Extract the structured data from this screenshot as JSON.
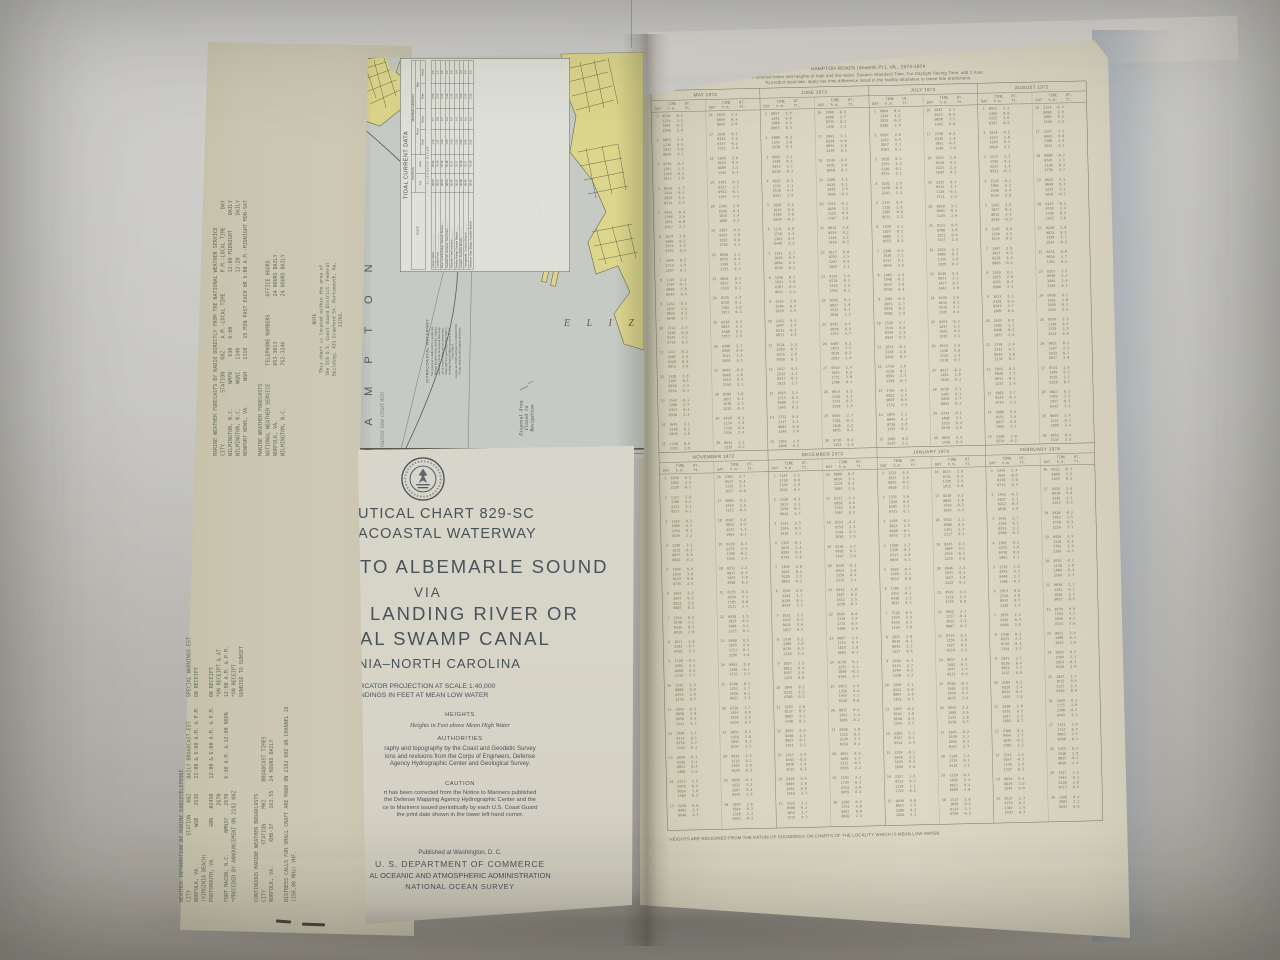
{
  "back_panel": {
    "radio_forecasts_lines": [
      "MARINE WEATHER FORECASTS BY RADIO DIRECTLY FROM THE NATIONAL WEATHER SERVICE",
      "CITY                 STATION    KHZ    A.M.-LOCAL TIME       P.M.-LOCAL TIME      DAY",
      "WILMINGTON, N.C.        WMFD     630   6:00                  12:00 MIDNIGHT     DAILY",
      "WILMINGTON, N.C.        WGNI    1340                         12:20              DAILY",
      "NEWPORT NEWS, VA.        WGH    1310   15 MIN PAST EACH HR 6:00 A.M.-MIDNIGHT MON-SAT",
      "",
      "MARINE WEATHER FORECASTS",
      "NATIONAL WEATHER SERVICE      TELEPHONE NUMBERS      OFFICE HOURS",
      "NORFOLK, VA.                  853-3013               24 HOURS DAILY",
      "WILMINGTON, N.C.              762-3246               24 HOURS DAILY"
    ],
    "note_lines": [
      "NOTE",
      "This chart is located within the area of",
      "the 5th U.S. Coast Guard District. Federal",
      "Building, 431 Crawford St. Portsmouth, Va.",
      "23705."
    ],
    "radiotelephone_lines": [
      "WEATHER INFORMATION BY MARINE RADIOTELEPHONE",
      "CITY                  STATION    KHZ     DAILY BROADCAST-EST        SPECIAL WARNINGS-EST",
      "NORFOLK, VA.             WGB    2536     12:00 & 6:00 A.M. & P.M.   ON RECEIPT",
      "(VIRGINIA BEACH)",
      "PORTSMOUTH, VA.          GBN   #2450     12:00 & 6:00 A.M. & P.M.   ON RECEIPT",
      "                                2670                                *ON RECEIPT & AT",
      "FORT MACON, N.C.       NMN37    2670     6:30 A.M. & 12:00 NOON     12:00 A.M. & P.M.",
      "*PRECEDED BY ANNOUNCEMENT ON 2182 KHZ                               *ON RECEIPT",
      "                                                                    SUNRISE TO SUNSET",
      "",
      "CONTINUOUS MARINE WEATHER BROADCASTS",
      "CITY               STATION     MHZ      BROADCAST TIMES",
      "NORFOLK, VA.        KHB-37     162.55   24 HOURS DAILY",
      "",
      "DISTRESS CALLS FOR SMALL CRAFT ARE MADE ON 2182 KHZ OR CHANNEL 16",
      "(156.80 MHz) VHF."
    ]
  },
  "map_panel": {
    "current_table": {
      "title": "TIDAL CURRENT DATA",
      "headers": {
        "place": "PLACE",
        "position": "POSITION",
        "lat": "Lat.",
        "long": "Long.",
        "currents": "MAXIMUM CURRENTS",
        "flood": "Flood",
        "ebb": "Ebb",
        "time": "Time",
        "knots": "Knots"
      },
      "group_label": "ELIZABETH RIVER",
      "rows": [
        {
          "name": "Craney Island..........................",
          "vals": "36 53|76 20|1 10|0.7|0 50|0.9"
        },
        {
          "name": "Lambert Point..........................",
          "vals": "36 52|76 20|1 25|0.8|1 05|1.0"
        },
        {
          "name": "West Norfolk Bridge, Western Branch....",
          "vals": "36 50|76 19|1 40|0.5|1 20|0.6"
        },
        {
          "name": "Southern Br. entrance, Town Point......",
          "vals": "36 50|76 18|1 55|0.4|1 30|0.5"
        },
        {
          "name": "Belleville Creek entrance..............",
          "vals": "36 49|76 17|2 05|0.4|1 45|0.5"
        },
        {
          "name": "Berkley Bridge, Eastern Branch.........",
          "vals": "36 50|76 17|2 15|0.3|1 55|0.4"
        },
        {
          "name": "Gosport, Southern Branch...............",
          "vals": "36 48|76 18|2 30|0.3|2 05|0.4"
        },
        {
          "name": "Chesapeake, Southern Branch............",
          "vals": "36 46|76 17|2 40|0.2|2 20|0.3"
        },
        {
          "name": "Gilmerton Swg. Bridge, Southern Branch.",
          "vals": "36 45|76 16|2 55|0.2|2 35|0.3"
        }
      ]
    },
    "labels": {
      "hampton": "H A M P T O N",
      "hampton_note": "for harbor see chart 400",
      "eliza": "E L I Z A",
      "stack": "STACK",
      "disposal_lines": [
        "Disposal Area",
        "Closed to",
        "Navigation"
      ]
    },
    "waterway_note": {
      "title": "INTRACOASTAL WATERWAY",
      "lines": [
        "The waterway is indicated by a purple line.",
        "Mileage distances from Norfolk, Virginia,",
        "southward, via the Intracoastal Waterway,",
        "are in Statute Miles and are shown thus:",
        "Some light lists governing White Mile to",
        "outlying Nautical Miles are given in U.S.",
        "Coast Pilot 4.",
        "Courses are TRUE and must be CORRECTED",
        "for any variation and compass deviation."
      ]
    }
  },
  "cover_panel": {
    "title_lines": [
      "UTICAL CHART 829-SC",
      "ACOASTAL WATERWAY",
      "TO ALBEMARLE SOUND",
      "VIA",
      "LANDING RIVER OR",
      "AL SWAMP CANAL",
      "NIA–NORTH CAROLINA"
    ],
    "scale_lines": [
      "ERCATOR PROJECTION AT SCALE 1:40,000",
      "UNDINGS IN FEET AT MEAN LOW WATER"
    ],
    "heights_heading": "HEIGHTS",
    "heights_text": "Heights in Feet above Mean High Water",
    "authorities_heading": "AUTHORITIES",
    "authorities_lines": [
      "raphy and topography by the Coast and Geodetic Survey",
      "ions and revisions from the Corps of Engineers, Defense",
      "Agency Hydrographic Center and Geological Survey."
    ],
    "caution_heading": "CAUTION",
    "caution_lines": [
      "rt has been corrected from the Notice to Mariners published",
      "the Defense Mapping Agency Hydrographic Center and the",
      "ce to Mariners issued periodically by each U.S. Coast Guard",
      "the print date shown in the lower left hand corner."
    ],
    "publisher_small": "Published at Washington, D. C.",
    "publisher_dept": "U. S. DEPARTMENT OF COMMERCE",
    "publisher_noaa": "AL OCEANIC AND ATMOSPHERIC ADMINISTRATION",
    "publisher_nos": "NATIONAL OCEAN SURVEY"
  },
  "tide_page": {
    "title": "HAMPTON ROADS (Sewells Pt.), VA., 1973-1974",
    "subtitle1": "Predicted times and heights of high and low water. Eastern Standard Time. For Daylight Saving Time, add 1 hour.",
    "subtitle2": "To predict local tide, apply the time difference listed in the facility tabulation to these tide predictions.",
    "column_headers": {
      "day": "DAY",
      "time": "TIME",
      "time_unit": "h.m.",
      "height": "HT.",
      "height_unit": "ft."
    },
    "bands": [
      {
        "months": [
          "MAY 1973",
          "JUNE 1973",
          "JULY 1973",
          "AUGUST 1973"
        ]
      },
      {
        "months": [
          "NOVEMBER 1973",
          "DECEMBER 1973",
          "JANUARY 1974",
          "FEBRUARY 1974"
        ]
      }
    ],
    "footnote": "HEIGHTS ARE RECKONED FROM THE DATUM OF SOUNDINGS ON CHARTS OF THE LOCALITY WHICH IS MEAN LOW WATER.",
    "body_filler": {
      "note": "prediction digits are below photographic legibility; regenerated as plausible filler",
      "days_per_half": 15,
      "lines_per_day": 4,
      "time_base_min": 287,
      "time_step_min": 50,
      "high_base": 2.1,
      "low_base": -0.3
    }
  },
  "colors": {
    "page_cream": "#d9d5c2",
    "back_tan": "#c9c5b0",
    "map_water": "#c5cac4",
    "map_land": "#dcd68c",
    "ink_olive": "#5f6a52",
    "ink_slate": "#49525a",
    "shadow_blue": "#a9b6c4"
  }
}
